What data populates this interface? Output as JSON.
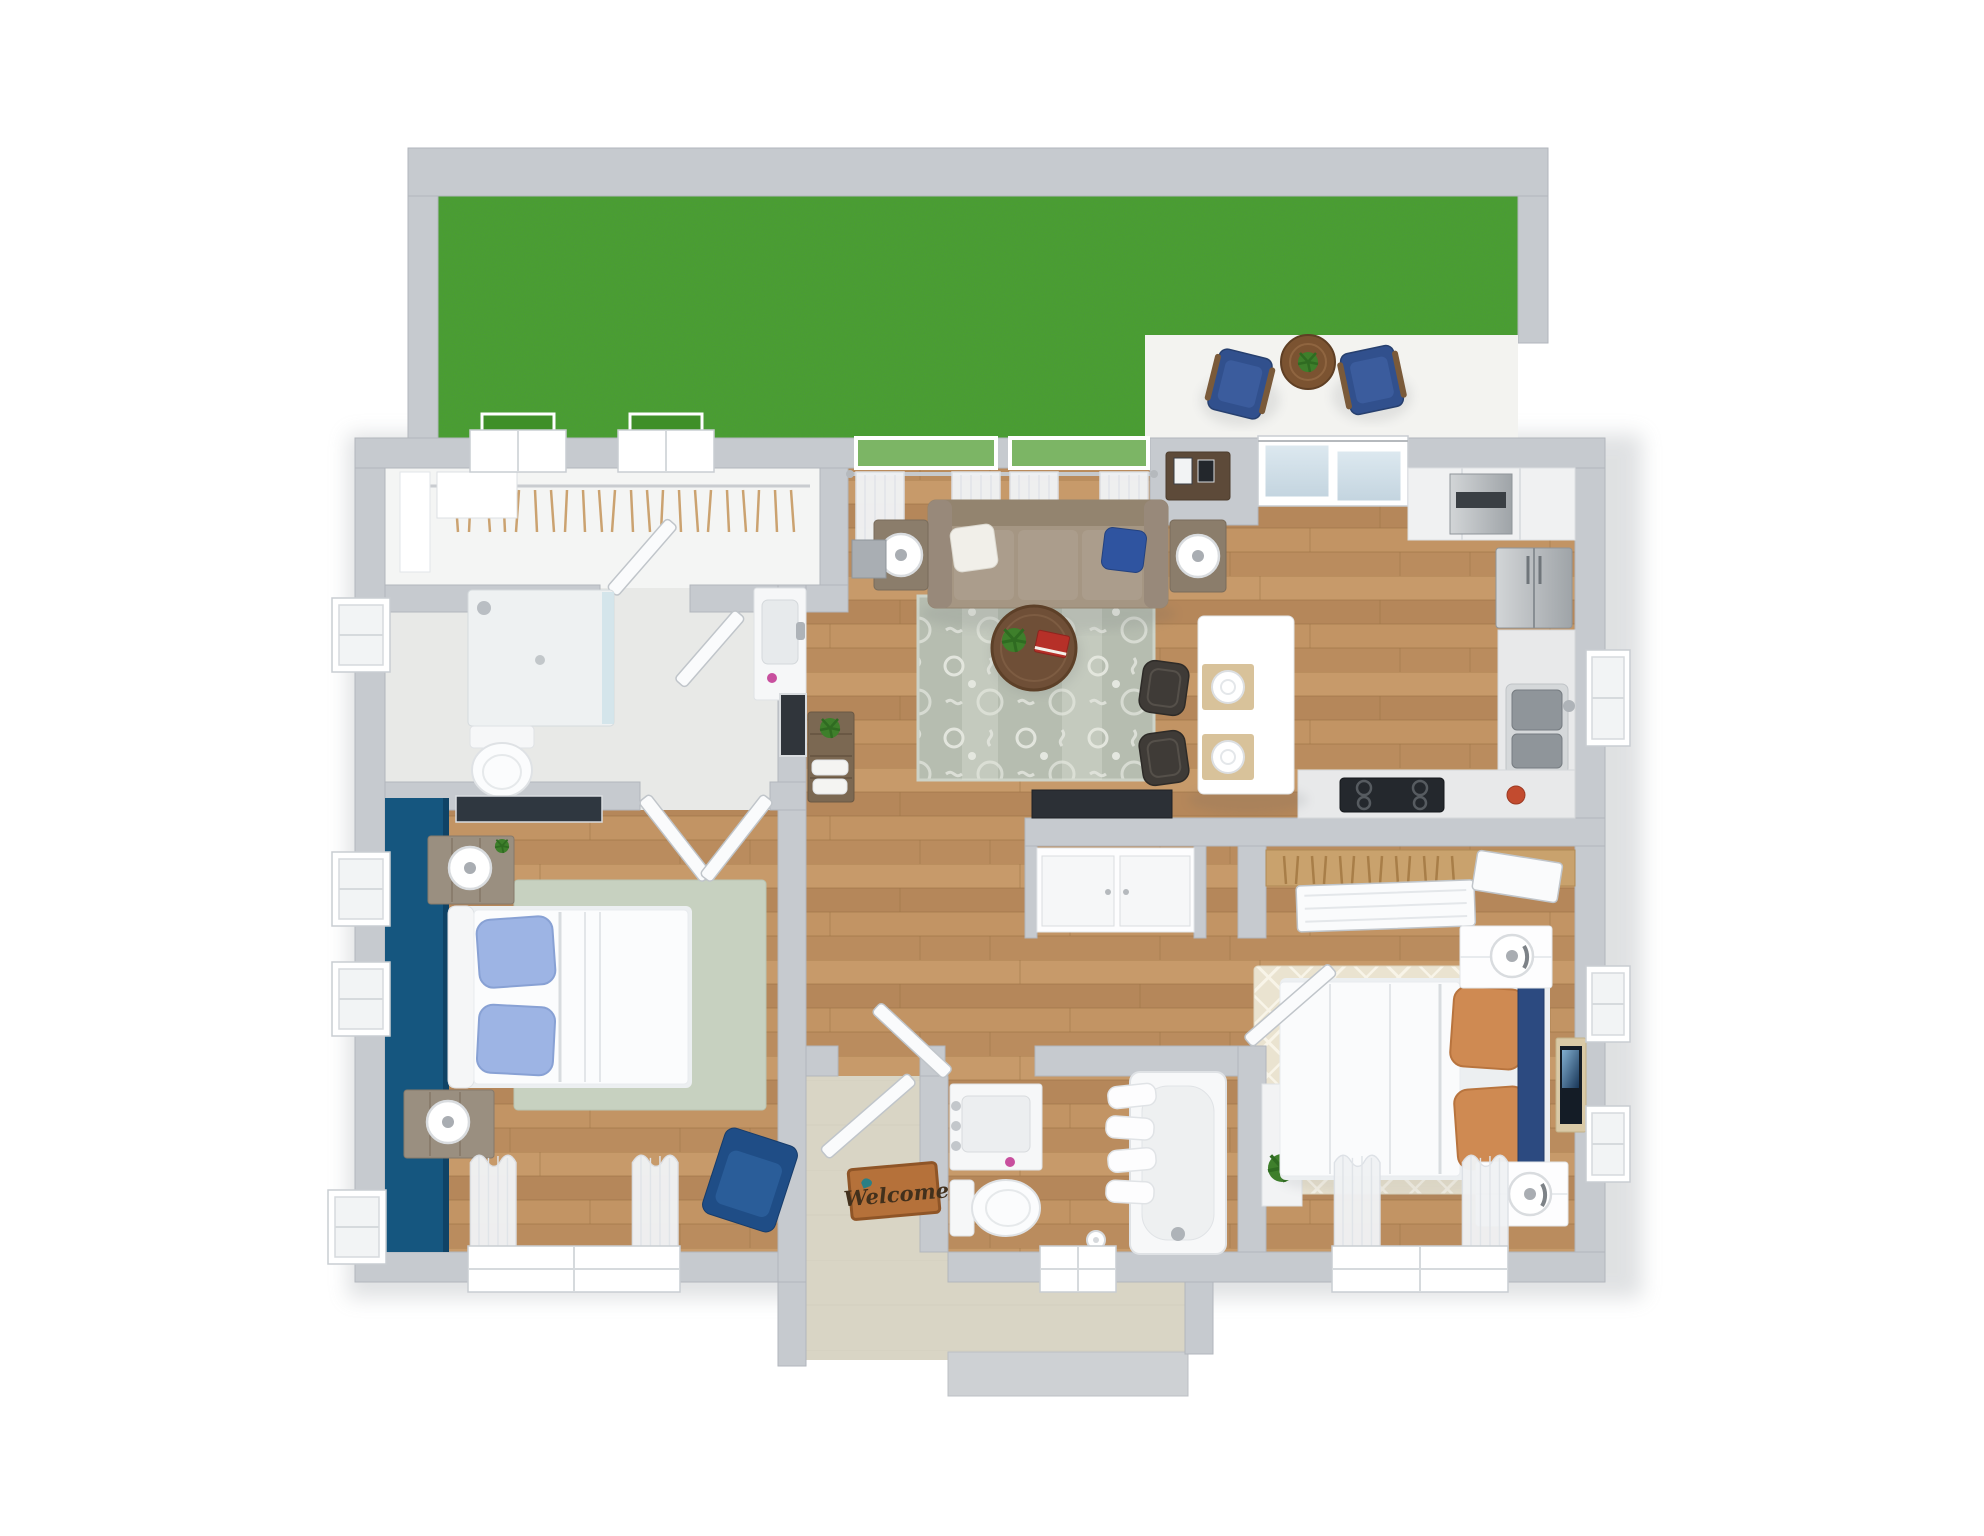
{
  "scene": {
    "type": "3d-floor-plan-render",
    "view": "top-down isometric",
    "background": "white",
    "bedrooms": 2,
    "bathrooms": 2
  },
  "entry": {
    "welcome_mat_text": "Welcome"
  },
  "palette": {
    "wall_gray": "#c6cacf",
    "wood_floor": "#bd9060",
    "grass_green": "#4aa22b",
    "patio_white": "#f3f3f0",
    "entry_tile": "#d9d5c5",
    "accent_wall_blue": "#15567f",
    "navy": "#2c4a80",
    "light_blue_pillow": "#9db4e4",
    "orange_pillow": "#cf8a52",
    "sofa_taupe": "#a59683",
    "living_rug": "#b6bdb0",
    "bedroom1_rug_sage": "#c7d1c0",
    "bedroom2_rug_cream": "#eae3d0",
    "dark_wood": "#6f4f37",
    "welcome_mat": "#b5713a",
    "stainless": "#aeb3b8",
    "cooktop_black": "#24282d"
  },
  "rooms": [
    {
      "name": "Backyard",
      "surface": "grass lawn enclosed by gray walls"
    },
    {
      "name": "Patio",
      "furniture": [
        "navy armchair",
        "navy armchair",
        "round bistro table with potted plant"
      ]
    },
    {
      "name": "Walk-in closet",
      "furniture": [
        "hanging rod with clothes hangers",
        "window with planter box",
        "window with planter box",
        "white dresser"
      ]
    },
    {
      "name": "Master bathroom",
      "furniture": [
        "glass walk-in shower",
        "vanity sink with faucet",
        "toilet",
        "side window"
      ]
    },
    {
      "name": "Master bedroom",
      "furniture": [
        "blue accent wall",
        "bed with white duvet and two light-blue pillows",
        "rustic nightstand with sphere lamp and plant",
        "rustic nightstand with sphere lamp",
        "sage area rug",
        "wall-mounted tv",
        "navy accent chair",
        "curtained rear window",
        "three side windows"
      ]
    },
    {
      "name": "Living room",
      "furniture": [
        "taupe three-seat sofa with white and navy pillows",
        "side table with white lamp",
        "side table with white lamp",
        "patterned gray area rug",
        "round dark-wood coffee table with red book and plant",
        "sheer curtains on two yard-facing windows",
        "wall shelf with picture frames",
        "console table with plant and towels",
        "framed wall art",
        "hall cabinet"
      ]
    },
    {
      "name": "Kitchen",
      "furniture": [
        "sliding glass patio door",
        "white upper cabinets",
        "stainless wall oven",
        "stainless refrigerator",
        "double stainless sink",
        "window over sink",
        "black cooktop on counter",
        "red canister",
        "white island with two place settings",
        "dark bar stool",
        "dark bar stool",
        "black coffee-bar counter"
      ]
    },
    {
      "name": "Utility nook",
      "furniture": [
        "white cabinet doors"
      ]
    },
    {
      "name": "Entry foyer",
      "furniture": [
        "tile floor",
        "welcome mat",
        "open front door",
        "porch walkway with step"
      ]
    },
    {
      "name": "Guest bathroom",
      "furniture": [
        "white vanity sink",
        "toilet with paper roll",
        "bathtub with four towels",
        "rear window",
        "plant shelf"
      ]
    },
    {
      "name": "Bedroom 2",
      "furniture": [
        "bed with white duvet, two orange pillows and navy headboard",
        "white nightstand with sphere lamp",
        "white nightstand with sphere lamp",
        "cream lattice rug",
        "wall-mounted tv",
        "closet with hanging rod and sliding doors",
        "curtained rear window",
        "two side windows"
      ]
    }
  ]
}
